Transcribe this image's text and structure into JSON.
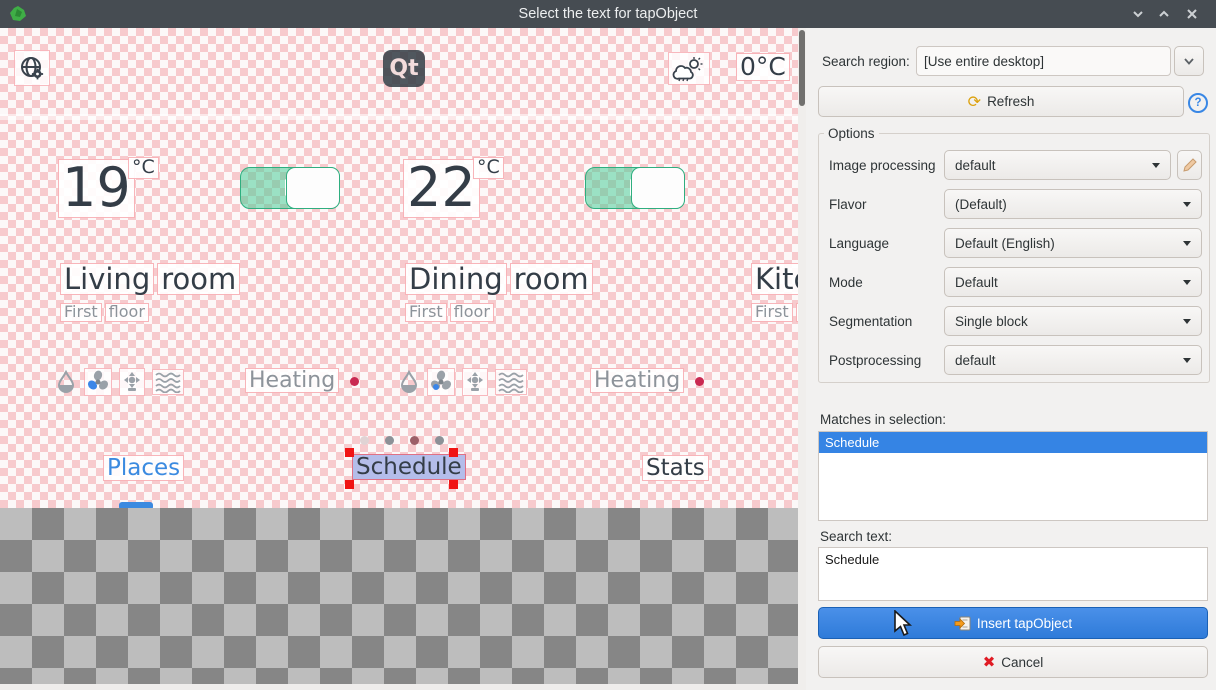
{
  "window": {
    "title": "Select the text for tapObject"
  },
  "preview": {
    "topbar": {
      "logo_text": "Qt",
      "outside_temp": "0°C"
    },
    "rooms": [
      {
        "temp": "19",
        "temp_unit": "°C",
        "name": "Living room",
        "floor": "First floor",
        "status": "Heating",
        "toggle_on": true
      },
      {
        "temp": "22",
        "temp_unit": "°C",
        "name": "Dining room",
        "floor": "First floor",
        "status": "Heating",
        "toggle_on": true
      },
      {
        "name": "Kitc",
        "floor": "First flo"
      }
    ],
    "tabs": [
      {
        "label": "Places",
        "active": true
      },
      {
        "label": "Schedule",
        "selected_by_marquee": true
      },
      {
        "label": "Stats"
      }
    ],
    "pagination_dot_colors": [
      "#e0d3d4",
      "#8c9197",
      "#9c5f68",
      "#8c9197"
    ]
  },
  "panel": {
    "search_region": {
      "label": "Search region:",
      "value": "[Use entire desktop]"
    },
    "refresh_label": "Refresh",
    "help_label": "?",
    "options": {
      "title": "Options",
      "rows": [
        {
          "label": "Image processing",
          "value": "default",
          "editable": true
        },
        {
          "label": "Flavor",
          "value": "(Default)"
        },
        {
          "label": "Language",
          "value": "Default (English)"
        },
        {
          "label": "Mode",
          "value": "Default"
        },
        {
          "label": "Segmentation",
          "value": "Single block"
        },
        {
          "label": "Postprocessing",
          "value": "default"
        }
      ]
    },
    "matches": {
      "label": "Matches in selection:",
      "items": [
        "Schedule"
      ],
      "selected_index": 0
    },
    "search_text": {
      "label": "Search text:",
      "value": "Schedule"
    },
    "insert_label": "Insert tapObject",
    "cancel_label": "Cancel"
  },
  "colors": {
    "accent_blue": "#3584e4",
    "titlebar": "#464c52",
    "panel_bg": "#f2f1f0",
    "toggle_green": "#4ace99",
    "marquee_handle_red": "#f01414",
    "selection_lavender": "#b4bdea"
  }
}
